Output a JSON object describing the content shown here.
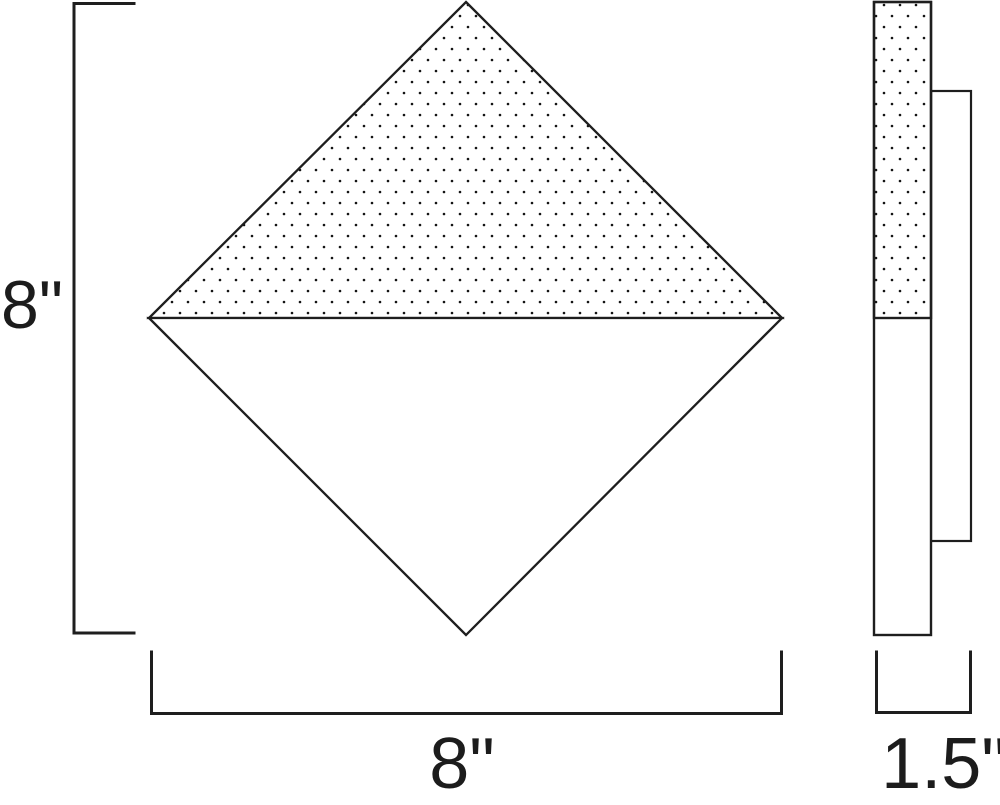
{
  "diagram": {
    "type": "technical-dimension-drawing",
    "background_color": "#ffffff",
    "line_color": "#1e1e1e",
    "stipple_dot_color": "#131313",
    "fill_color": "#ffffff",
    "dimensions": {
      "height": {
        "label": "8\"",
        "value": 8,
        "unit": "in"
      },
      "width": {
        "label": "8\"",
        "value": 8,
        "unit": "in"
      },
      "depth": {
        "label": "1.5\"",
        "value": 1.5,
        "unit": "in"
      }
    }
  }
}
